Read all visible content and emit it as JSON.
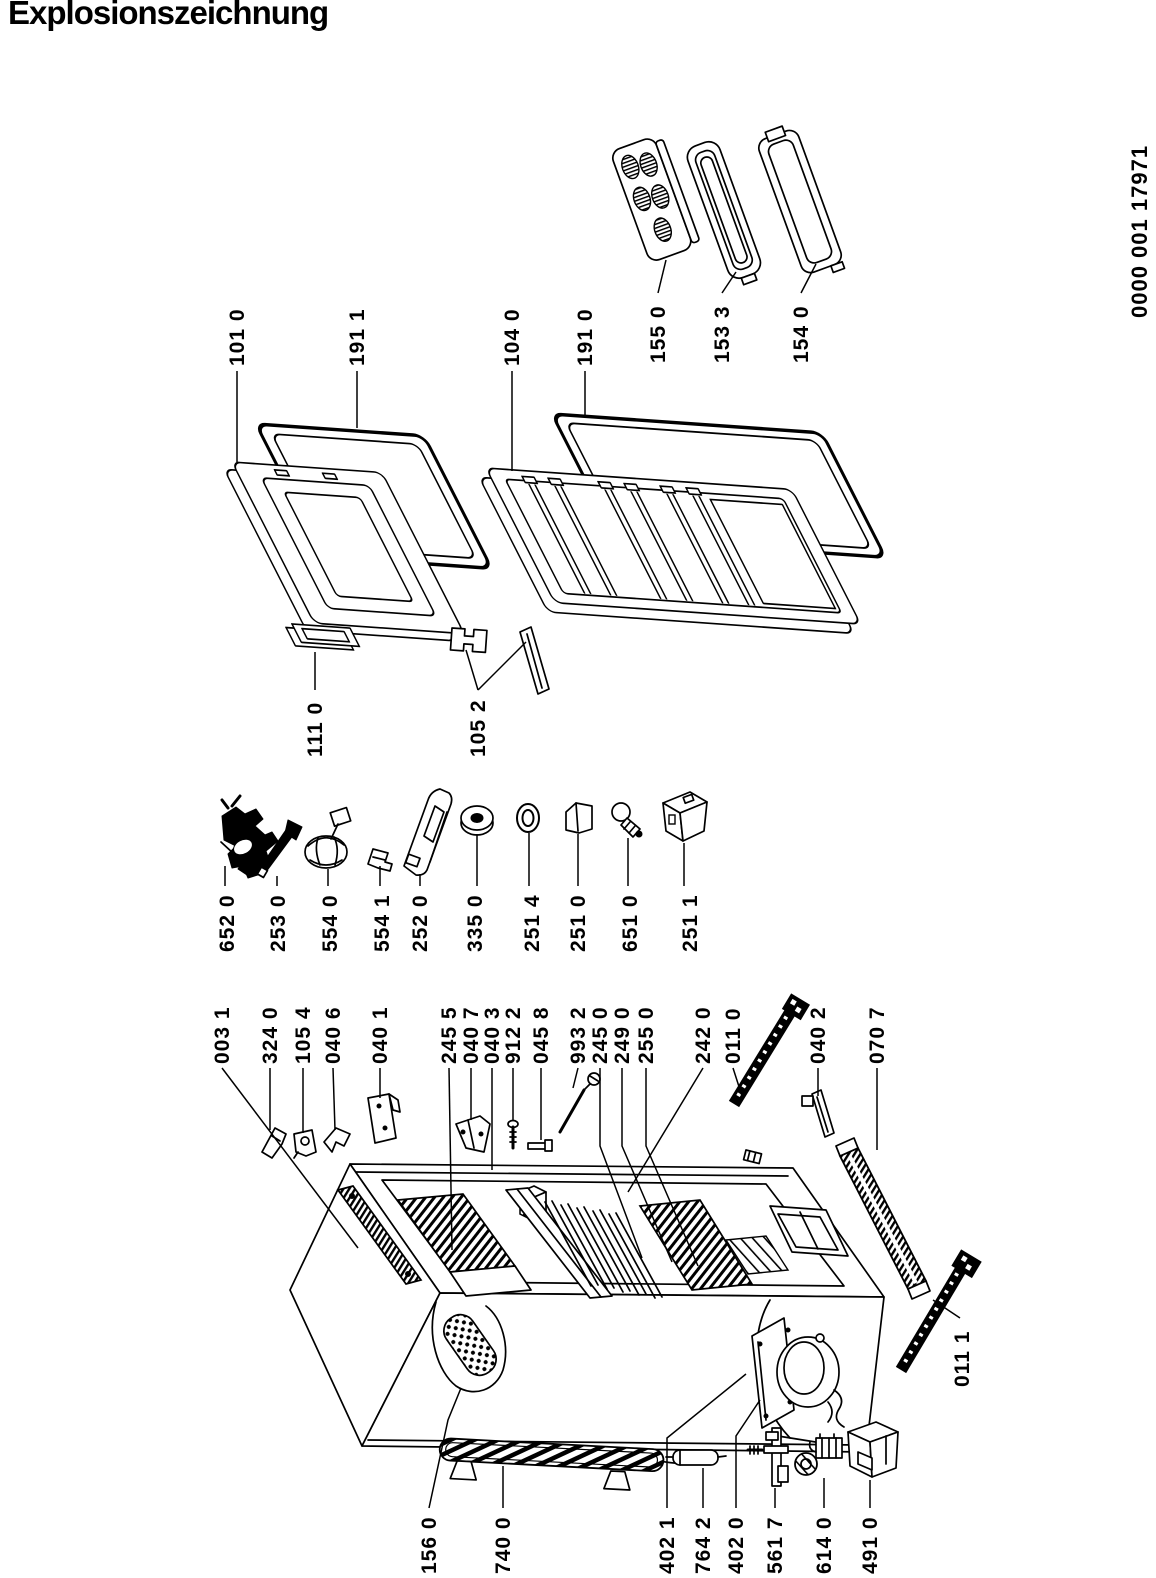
{
  "title": "Explosionszeichnung",
  "doc_number": "0000 001 17971",
  "drawing": {
    "ink": "#000000",
    "paper": "#ffffff"
  },
  "callouts": [
    {
      "id": "101-0",
      "label": "101 0",
      "tx": 237,
      "ty": 366,
      "lead": [
        [
          237,
          371
        ],
        [
          237,
          462
        ]
      ]
    },
    {
      "id": "191-1",
      "label": "191 1",
      "tx": 357,
      "ty": 366,
      "lead": [
        [
          357,
          371
        ],
        [
          357,
          428
        ]
      ]
    },
    {
      "id": "104-0",
      "label": "104 0",
      "tx": 512,
      "ty": 366,
      "lead": [
        [
          512,
          371
        ],
        [
          512,
          471
        ]
      ]
    },
    {
      "id": "191-0",
      "label": "191 0",
      "tx": 585,
      "ty": 366,
      "lead": [
        [
          585,
          371
        ],
        [
          585,
          418
        ]
      ]
    },
    {
      "id": "155-0",
      "label": "155 0",
      "tx": 658,
      "ty": 363,
      "lead": [
        [
          658,
          293
        ],
        [
          666,
          260
        ]
      ]
    },
    {
      "id": "153-3",
      "label": "153 3",
      "tx": 722,
      "ty": 363,
      "lead": [
        [
          722,
          293
        ],
        [
          736,
          272
        ]
      ]
    },
    {
      "id": "154-0",
      "label": "154 0",
      "tx": 801,
      "ty": 363,
      "lead": [
        [
          801,
          293
        ],
        [
          816,
          264
        ]
      ]
    },
    {
      "id": "111-0",
      "label": "111 0",
      "tx": 315,
      "ty": 757,
      "lead": [
        [
          315,
          690
        ],
        [
          315,
          652
        ]
      ]
    },
    {
      "id": "105-2",
      "label": "105 2",
      "tx": 478,
      "ty": 757,
      "lead": [
        [
          478,
          690
        ],
        [
          466,
          650
        ]
      ],
      "lead2": [
        [
          478,
          690
        ],
        [
          526,
          642
        ]
      ]
    },
    {
      "id": "652-0",
      "label": "652 0",
      "tx": 227,
      "ty": 952,
      "lead": [
        [
          225,
          886
        ],
        [
          225,
          866
        ]
      ]
    },
    {
      "id": "253-0",
      "label": "253 0",
      "tx": 278,
      "ty": 952,
      "lead": [
        [
          277,
          886
        ],
        [
          277,
          876
        ]
      ]
    },
    {
      "id": "554-0",
      "label": "554 0",
      "tx": 330,
      "ty": 952,
      "lead": [
        [
          328,
          886
        ],
        [
          328,
          869
        ]
      ]
    },
    {
      "id": "554-1",
      "label": "554 1",
      "tx": 382,
      "ty": 952,
      "lead": [
        [
          380,
          886
        ],
        [
          380,
          866
        ]
      ]
    },
    {
      "id": "252-0",
      "label": "252 0",
      "tx": 420,
      "ty": 952,
      "lead": [
        [
          420,
          886
        ],
        [
          420,
          874
        ]
      ]
    },
    {
      "id": "335-0",
      "label": "335 0",
      "tx": 475,
      "ty": 952,
      "lead": [
        [
          477,
          886
        ],
        [
          477,
          834
        ]
      ]
    },
    {
      "id": "251-4",
      "label": "251 4",
      "tx": 532,
      "ty": 952,
      "lead": [
        [
          529,
          886
        ],
        [
          529,
          833
        ]
      ]
    },
    {
      "id": "251-0",
      "label": "251 0",
      "tx": 578,
      "ty": 952,
      "lead": [
        [
          578,
          886
        ],
        [
          578,
          834
        ]
      ]
    },
    {
      "id": "651-0",
      "label": "651 0",
      "tx": 630,
      "ty": 952,
      "lead": [
        [
          628,
          886
        ],
        [
          628,
          838
        ]
      ]
    },
    {
      "id": "251-1",
      "label": "251 1",
      "tx": 690,
      "ty": 952,
      "lead": [
        [
          684,
          886
        ],
        [
          684,
          843
        ]
      ]
    },
    {
      "id": "003-1",
      "label": "003 1",
      "tx": 222,
      "ty": 1064,
      "lead": [
        [
          222,
          1068
        ],
        [
          358,
          1248
        ]
      ]
    },
    {
      "id": "324-0",
      "label": "324 0",
      "tx": 270,
      "ty": 1064,
      "lead": [
        [
          270,
          1068
        ],
        [
          270,
          1130
        ]
      ]
    },
    {
      "id": "105-4",
      "label": "105 4",
      "tx": 303,
      "ty": 1064,
      "lead": [
        [
          303,
          1068
        ],
        [
          303,
          1133
        ]
      ]
    },
    {
      "id": "040-6",
      "label": "040 6",
      "tx": 333,
      "ty": 1064,
      "lead": [
        [
          333,
          1068
        ],
        [
          335,
          1130
        ]
      ]
    },
    {
      "id": "040-1",
      "label": "040 1",
      "tx": 380,
      "ty": 1064,
      "lead": [
        [
          380,
          1068
        ],
        [
          380,
          1098
        ]
      ]
    },
    {
      "id": "245-5",
      "label": "245 5",
      "tx": 449,
      "ty": 1064,
      "lead": [
        [
          449,
          1068
        ],
        [
          452,
          1250
        ]
      ]
    },
    {
      "id": "040-7",
      "label": "040 7",
      "tx": 471,
      "ty": 1064,
      "lead": [
        [
          471,
          1068
        ],
        [
          471,
          1120
        ]
      ]
    },
    {
      "id": "040-3",
      "label": "040 3",
      "tx": 492,
      "ty": 1064,
      "lead": [
        [
          492,
          1068
        ],
        [
          492,
          1170
        ]
      ]
    },
    {
      "id": "912-2",
      "label": "912 2",
      "tx": 513,
      "ty": 1064,
      "lead": [
        [
          513,
          1068
        ],
        [
          513,
          1120
        ]
      ]
    },
    {
      "id": "045-8",
      "label": "045 8",
      "tx": 541,
      "ty": 1064,
      "lead": [
        [
          541,
          1068
        ],
        [
          541,
          1140
        ]
      ]
    },
    {
      "id": "993-2",
      "label": "993 2",
      "tx": 578,
      "ty": 1064,
      "lead": [
        [
          578,
          1068
        ],
        [
          573,
          1088
        ]
      ]
    },
    {
      "id": "245-0",
      "label": "245 0",
      "tx": 600,
      "ty": 1064,
      "lead": [
        [
          600,
          1068
        ],
        [
          600,
          1146
        ],
        [
          642,
          1258
        ]
      ]
    },
    {
      "id": "249-0",
      "label": "249 0",
      "tx": 622,
      "ty": 1064,
      "lead": [
        [
          622,
          1068
        ],
        [
          622,
          1146
        ],
        [
          672,
          1262
        ]
      ]
    },
    {
      "id": "255-0",
      "label": "255 0",
      "tx": 646,
      "ty": 1064,
      "lead": [
        [
          646,
          1068
        ],
        [
          646,
          1146
        ],
        [
          698,
          1266
        ]
      ]
    },
    {
      "id": "242-0",
      "label": "242 0",
      "tx": 703,
      "ty": 1064,
      "lead": [
        [
          703,
          1068
        ],
        [
          628,
          1192
        ]
      ]
    },
    {
      "id": "011-0",
      "label": "011 0",
      "tx": 733,
      "ty": 1064,
      "lead": [
        [
          733,
          1068
        ],
        [
          742,
          1096
        ]
      ]
    },
    {
      "id": "040-2",
      "label": "040 2",
      "tx": 818,
      "ty": 1064,
      "lead": [
        [
          818,
          1068
        ],
        [
          818,
          1096
        ]
      ]
    },
    {
      "id": "070-7",
      "label": "070 7",
      "tx": 877,
      "ty": 1064,
      "lead": [
        [
          877,
          1068
        ],
        [
          877,
          1150
        ]
      ]
    },
    {
      "id": "011-1",
      "label": "011 1",
      "tx": 962,
      "ty": 1387,
      "lead": [
        [
          960,
          1318
        ],
        [
          933,
          1300
        ]
      ]
    },
    {
      "id": "156-0",
      "label": "156 0",
      "tx": 429,
      "ty": 1574,
      "lead": [
        [
          429,
          1508
        ],
        [
          448,
          1420
        ],
        [
          461,
          1388
        ]
      ]
    },
    {
      "id": "740-0",
      "label": "740 0",
      "tx": 503,
      "ty": 1574,
      "lead": [
        [
          503,
          1508
        ],
        [
          503,
          1466
        ]
      ]
    },
    {
      "id": "402-1",
      "label": "402 1",
      "tx": 667,
      "ty": 1574,
      "lead": [
        [
          667,
          1508
        ],
        [
          667,
          1438
        ],
        [
          746,
          1374
        ]
      ]
    },
    {
      "id": "764-2",
      "label": "764 2",
      "tx": 703,
      "ty": 1574,
      "lead": [
        [
          703,
          1508
        ],
        [
          703,
          1468
        ]
      ]
    },
    {
      "id": "402-0",
      "label": "402 0",
      "tx": 736,
      "ty": 1574,
      "lead": [
        [
          736,
          1508
        ],
        [
          736,
          1436
        ],
        [
          760,
          1400
        ]
      ]
    },
    {
      "id": "561-7",
      "label": "561 7",
      "tx": 775,
      "ty": 1574,
      "lead": [
        [
          775,
          1508
        ],
        [
          775,
          1488
        ]
      ]
    },
    {
      "id": "614-0",
      "label": "614 0",
      "tx": 824,
      "ty": 1574,
      "lead": [
        [
          824,
          1508
        ],
        [
          824,
          1478
        ]
      ]
    },
    {
      "id": "491-0",
      "label": "491 0",
      "tx": 870,
      "ty": 1574,
      "lead": [
        [
          870,
          1508
        ],
        [
          870,
          1480
        ]
      ]
    },
    {
      "id": "doc-number",
      "label": "0000 001 17971",
      "tx": 1140,
      "ty": 318,
      "cls": "doc"
    }
  ]
}
